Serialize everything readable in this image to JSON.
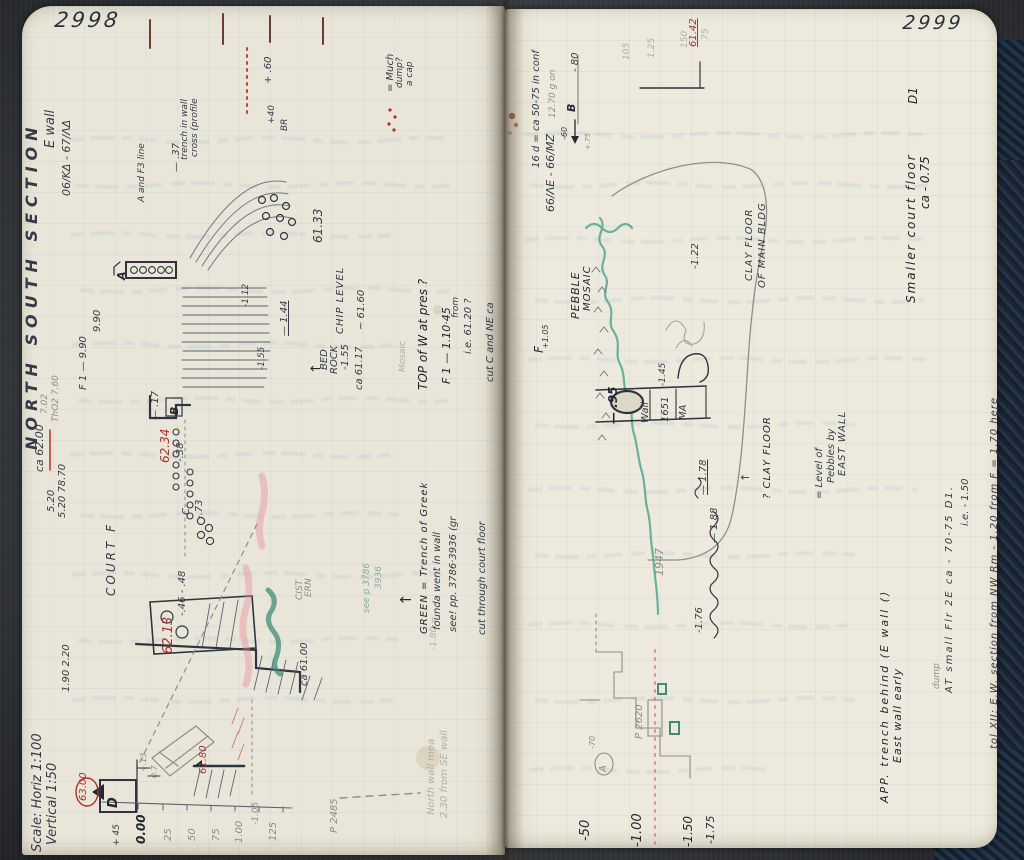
{
  "notebook": {
    "left_page": {
      "page_number": "2998"
    },
    "right_page": {
      "page_number": "2999"
    },
    "colors": {
      "ink": "#343b46",
      "red_ink": "#a63232",
      "green_ink": "#3e8d78",
      "pencil": "#8e8c84",
      "page": "#e9e6d9",
      "cover": "#22344a"
    },
    "annotations": [
      {
        "t": "NORTH  SOUTH  SECTION",
        "x": 24,
        "y": 450,
        "s": 16,
        "ls": 6,
        "c": "ink",
        "w": 600
      },
      {
        "t": "E wall",
        "x": 44,
        "y": 148,
        "s": 13,
        "c": "ink"
      },
      {
        "t": "06/ΚΔ - 67/ΛΔ",
        "x": 61,
        "y": 196,
        "s": 11,
        "c": "ink"
      },
      {
        "t": "ca 62.00",
        "x": 34,
        "y": 472,
        "s": 11,
        "c": "ink"
      },
      {
        "t": "5.20",
        "x": 47,
        "y": 512,
        "s": 10,
        "c": "ink"
      },
      {
        "t": "5.20 78.70",
        "x": 58,
        "y": 518,
        "s": 10,
        "c": "ink"
      },
      {
        "t": "1.90  2.20",
        "x": 62,
        "y": 692,
        "s": 10,
        "c": "ink"
      },
      {
        "t": "Scale:  Horiz  1:100",
        "x": 31,
        "y": 852,
        "s": 13,
        "c": "ink"
      },
      {
        "t": "Vertical 1:50",
        "x": 46,
        "y": 845,
        "s": 13,
        "c": "ink"
      },
      {
        "t": "COURT  F",
        "x": 105,
        "y": 596,
        "s": 12,
        "ls": 3,
        "c": "ink"
      },
      {
        "t": "9.90",
        "x": 93,
        "y": 332,
        "s": 10,
        "c": "ink"
      },
      {
        "t": "F 1  —  9.90",
        "x": 79,
        "y": 390,
        "s": 10,
        "c": "ink"
      },
      {
        "t": "7.02",
        "x": 41,
        "y": 414,
        "s": 9,
        "c": "pencil"
      },
      {
        "t": "ThO2 7.60",
        "x": 52,
        "y": 422,
        "s": 9,
        "c": "pencil"
      },
      {
        "t": "A and F3 line",
        "x": 138,
        "y": 202,
        "s": 9,
        "c": "ink"
      },
      {
        "t": "— .37",
        "x": 172,
        "y": 172,
        "s": 10,
        "c": "ink"
      },
      {
        "t": "trench in wall",
        "x": 181,
        "y": 160,
        "s": 9,
        "c": "ink"
      },
      {
        "t": "cross (profile",
        "x": 191,
        "y": 157,
        "s": 9,
        "c": "ink"
      },
      {
        "t": "= Much",
        "x": 386,
        "y": 92,
        "s": 10,
        "c": "ink"
      },
      {
        "t": "dump?",
        "x": 396,
        "y": 88,
        "s": 9,
        "c": "ink"
      },
      {
        "t": "a cap",
        "x": 406,
        "y": 86,
        "s": 9,
        "c": "ink"
      },
      {
        "t": "+ .60",
        "x": 264,
        "y": 84,
        "s": 10,
        "c": "ink"
      },
      {
        "t": "+40",
        "x": 268,
        "y": 124,
        "s": 9,
        "c": "ink"
      },
      {
        "t": "BR",
        "x": 281,
        "y": 131,
        "s": 9,
        "c": "ink"
      },
      {
        "t": "61.33",
        "x": 312,
        "y": 243,
        "s": 12,
        "c": "ink"
      },
      {
        "t": "A",
        "x": 116,
        "y": 280,
        "s": 11,
        "c": "dark",
        "w": 600
      },
      {
        "t": "CHIP LEVEL",
        "x": 336,
        "y": 334,
        "s": 10,
        "ls": 1,
        "c": "ink"
      },
      {
        "t": "~ 61.60",
        "x": 357,
        "y": 330,
        "s": 10,
        "c": "ink"
      },
      {
        "t": "BED",
        "x": 320,
        "y": 370,
        "s": 10,
        "c": "ink"
      },
      {
        "t": "ROCK",
        "x": 330,
        "y": 374,
        "s": 10,
        "c": "ink"
      },
      {
        "t": "-1.55",
        "x": 341,
        "y": 370,
        "s": 10,
        "c": "ink"
      },
      {
        "t": "ca 61.17",
        "x": 355,
        "y": 390,
        "s": 10,
        "c": "ink"
      },
      {
        "t": "↑",
        "x": 310,
        "y": 374,
        "s": 13,
        "c": "dark"
      },
      {
        "t": "— 1.44",
        "x": 280,
        "y": 336,
        "s": 10,
        "c": "ink",
        "u": true
      },
      {
        "t": "-1.55",
        "x": 258,
        "y": 370,
        "s": 9,
        "c": "ink"
      },
      {
        "t": "-1.12",
        "x": 242,
        "y": 307,
        "s": 9,
        "c": "ink"
      },
      {
        "t": "— .17",
        "x": 151,
        "y": 420,
        "s": 10,
        "c": "ink"
      },
      {
        "t": "B",
        "x": 169,
        "y": 415,
        "s": 11,
        "c": "dark",
        "w": 600
      },
      {
        "t": "62.34",
        "x": 159,
        "y": 463,
        "s": 12,
        "c": "red"
      },
      {
        "t": "-.38",
        "x": 176,
        "y": 462,
        "s": 10,
        "c": "ink"
      },
      {
        "t": "C",
        "x": 182,
        "y": 515,
        "s": 10,
        "c": "ink"
      },
      {
        "t": "-.73",
        "x": 195,
        "y": 519,
        "s": 10,
        "c": "ink"
      },
      {
        "t": "62.13",
        "x": 162,
        "y": 654,
        "s": 13,
        "c": "red"
      },
      {
        "t": "-.46 - .48",
        "x": 178,
        "y": 616,
        "s": 10,
        "c": "ink"
      },
      {
        "t": "ca 61.00",
        "x": 300,
        "y": 686,
        "s": 10,
        "c": "ink"
      },
      {
        "t": "CIST",
        "x": 296,
        "y": 600,
        "s": 9,
        "c": "pencil"
      },
      {
        "t": "ERN",
        "x": 305,
        "y": 597,
        "s": 9,
        "c": "pencil"
      },
      {
        "t": "63.00",
        "x": 79,
        "y": 801,
        "s": 10,
        "c": "red"
      },
      {
        "t": "D",
        "x": 107,
        "y": 808,
        "s": 13,
        "c": "dark",
        "w": 600
      },
      {
        "t": "+ 45",
        "x": 113,
        "y": 846,
        "s": 9,
        "c": "ink"
      },
      {
        "t": "0.00",
        "x": 135,
        "y": 844,
        "s": 12,
        "c": "dark",
        "w": 700
      },
      {
        "t": "25",
        "x": 164,
        "y": 841,
        "s": 10,
        "c": "pencil"
      },
      {
        "t": "50",
        "x": 188,
        "y": 841,
        "s": 10,
        "c": "pencil"
      },
      {
        "t": "75",
        "x": 212,
        "y": 841,
        "s": 10,
        "c": "pencil"
      },
      {
        "t": "1.00",
        "x": 235,
        "y": 843,
        "s": 10,
        "c": "pencil"
      },
      {
        "t": "125",
        "x": 269,
        "y": 841,
        "s": 10,
        "c": "pencil"
      },
      {
        "t": "-1.05",
        "x": 252,
        "y": 825,
        "s": 9,
        "c": "pencil"
      },
      {
        "t": "61.80",
        "x": 199,
        "y": 774,
        "s": 10,
        "c": "red"
      },
      {
        "t": "+.13",
        "x": 140,
        "y": 772,
        "s": 8,
        "c": "pencil"
      },
      {
        "t": "0.7",
        "x": 151,
        "y": 778,
        "s": 8,
        "c": "pencil"
      },
      {
        "t": "P 2485",
        "x": 330,
        "y": 833,
        "s": 10,
        "c": "pencil"
      },
      {
        "t": "North wall mea",
        "x": 427,
        "y": 815,
        "s": 10,
        "c": "faint"
      },
      {
        "t": "2.30 from SE wall",
        "x": 440,
        "y": 818,
        "s": 10,
        "c": "faint"
      },
      {
        "t": "-1.80 =",
        "x": 430,
        "y": 650,
        "s": 9,
        "c": "faint"
      },
      {
        "t": "Mosaic",
        "x": 399,
        "y": 372,
        "s": 9,
        "c": "faint"
      },
      {
        "t": "TOP of W at pres ?",
        "x": 417,
        "y": 390,
        "s": 12,
        "c": "dark"
      },
      {
        "t": "F 1  — 1.10·45",
        "x": 441,
        "y": 384,
        "s": 11,
        "c": "dark"
      },
      {
        "t": "from",
        "x": 452,
        "y": 318,
        "s": 9,
        "c": "ink"
      },
      {
        "t": "i.e. 61.20 ?",
        "x": 464,
        "y": 354,
        "s": 10,
        "c": "ink"
      },
      {
        "t": "cut C and NE ca",
        "x": 486,
        "y": 382,
        "s": 10,
        "c": "ink"
      },
      {
        "t": "↑",
        "x": 399,
        "y": 606,
        "s": 15,
        "c": "dark"
      },
      {
        "t": "GREEN = Trench of Greek",
        "x": 420,
        "y": 634,
        "s": 10,
        "ls": 1,
        "c": "dark"
      },
      {
        "t": "founda went in wall",
        "x": 433,
        "y": 630,
        "s": 10,
        "c": "ink"
      },
      {
        "t": "see! pp. 3786·3936 (gr",
        "x": 449,
        "y": 632,
        "s": 10,
        "c": "ink"
      },
      {
        "t": "cut through court floor",
        "x": 478,
        "y": 635,
        "s": 10,
        "c": "ink"
      },
      {
        "t": "see p 3786",
        "x": 363,
        "y": 613,
        "s": 9,
        "c": "greenpencil"
      },
      {
        "t": "3936",
        "x": 375,
        "y": 589,
        "s": 9,
        "c": "greenpencil"
      },
      {
        "t": "16 d = ca 50-75 in conf",
        "x": 532,
        "y": 168,
        "s": 10,
        "c": "ink"
      },
      {
        "t": "66/ΛΕ - 66/ΜΖ",
        "x": 545,
        "y": 212,
        "s": 11,
        "c": "ink"
      },
      {
        "t": "12.70 g on",
        "x": 549,
        "y": 118,
        "s": 9,
        "c": "pencil"
      },
      {
        "t": "- 80",
        "x": 571,
        "y": 72,
        "s": 10,
        "c": "ink"
      },
      {
        "t": "B",
        "x": 566,
        "y": 112,
        "s": 11,
        "c": "dark",
        "w": 600
      },
      {
        "t": "-60",
        "x": 561,
        "y": 140,
        "s": 8,
        "c": "ink"
      },
      {
        "t": "+.75",
        "x": 585,
        "y": 150,
        "s": 7,
        "c": "pencil"
      },
      {
        "t": "105",
        "x": 623,
        "y": 60,
        "s": 9,
        "c": "faint"
      },
      {
        "t": "1.25",
        "x": 648,
        "y": 58,
        "s": 9,
        "c": "faint"
      },
      {
        "t": "150",
        "x": 681,
        "y": 48,
        "s": 9,
        "c": "faint"
      },
      {
        "t": "75",
        "x": 702,
        "y": 40,
        "s": 9,
        "c": "faint"
      },
      {
        "t": "61.42",
        "x": 689,
        "y": 47,
        "s": 10,
        "c": "red",
        "u": true
      },
      {
        "t": "F",
        "x": 533,
        "y": 353,
        "s": 12,
        "c": "dark"
      },
      {
        "t": "+1.05",
        "x": 542,
        "y": 349,
        "s": 8,
        "c": "ink"
      },
      {
        "t": "PEBBLE",
        "x": 570,
        "y": 319,
        "s": 11,
        "ls": 1,
        "c": "dark"
      },
      {
        "t": "MOSAIC",
        "x": 583,
        "y": 311,
        "s": 10,
        "ls": 1,
        "c": "dark"
      },
      {
        "t": "-1.22",
        "x": 691,
        "y": 269,
        "s": 10,
        "c": "ink"
      },
      {
        "t": "CLAY FLOOR",
        "x": 745,
        "y": 281,
        "s": 10,
        "ls": 1,
        "c": "ink"
      },
      {
        "t": "OF MAIN BLDG",
        "x": 758,
        "y": 288,
        "s": 10,
        "ls": 1,
        "c": "ink"
      },
      {
        "t": "— .95",
        "x": 607,
        "y": 424,
        "s": 12,
        "c": "dark",
        "w": 600
      },
      {
        "t": "Wall",
        "x": 641,
        "y": 423,
        "s": 10,
        "c": "ink"
      },
      {
        "t": "1651",
        "x": 661,
        "y": 422,
        "s": 10,
        "c": "ink"
      },
      {
        "t": "MA",
        "x": 679,
        "y": 420,
        "s": 10,
        "c": "ink"
      },
      {
        "t": "-1.45",
        "x": 659,
        "y": 386,
        "s": 9,
        "c": "ink"
      },
      {
        "t": "— 1.78",
        "x": 699,
        "y": 495,
        "s": 10,
        "c": "ink",
        "u": true
      },
      {
        "t": "— 1.88",
        "x": 710,
        "y": 543,
        "s": 10,
        "c": "ink"
      },
      {
        "t": "1947",
        "x": 654,
        "y": 576,
        "s": 11,
        "c": "pencil"
      },
      {
        "t": "-1.76",
        "x": 695,
        "y": 633,
        "s": 10,
        "c": "ink"
      },
      {
        "t": "↑",
        "x": 740,
        "y": 482,
        "s": 11,
        "c": "ink"
      },
      {
        "t": "? CLAY FLOOR",
        "x": 763,
        "y": 499,
        "s": 10,
        "ls": 1,
        "c": "dark"
      },
      {
        "t": "= Level of",
        "x": 815,
        "y": 499,
        "s": 10,
        "c": "ink"
      },
      {
        "t": "Pebbles by",
        "x": 827,
        "y": 483,
        "s": 10,
        "c": "ink"
      },
      {
        "t": "EAST WALL",
        "x": 838,
        "y": 476,
        "s": 10,
        "ls": 1,
        "c": "ink"
      },
      {
        "t": "D1",
        "x": 907,
        "y": 104,
        "s": 12,
        "c": "dark"
      },
      {
        "t": "Smaller court floor",
        "x": 905,
        "y": 303,
        "s": 12,
        "ls": 2,
        "c": "dark"
      },
      {
        "t": "ca - 0.75",
        "x": 919,
        "y": 209,
        "s": 12,
        "c": "dark"
      },
      {
        "t": "APP. trench behind (E wall ()",
        "x": 879,
        "y": 803,
        "s": 11,
        "ls": 2,
        "c": "dark"
      },
      {
        "t": "East wall early",
        "x": 892,
        "y": 763,
        "s": 11,
        "ls": 1,
        "c": "dark"
      },
      {
        "t": "dump",
        "x": 933,
        "y": 689,
        "s": 9,
        "c": "pencil"
      },
      {
        "t": "AT small Flr 2E ca - 70-75 D1.",
        "x": 945,
        "y": 693,
        "s": 10,
        "ls": 2,
        "c": "ink"
      },
      {
        "t": "i.e. - 1.50",
        "x": 961,
        "y": 526,
        "s": 10,
        "c": "ink"
      },
      {
        "t": "tol XII: E.W. section from NW Rm - 1.20 from F = 1.70 here",
        "x": 990,
        "y": 749,
        "s": 10,
        "ls": 1,
        "c": "ink"
      },
      {
        "t": "-50",
        "x": 579,
        "y": 841,
        "s": 13,
        "c": "dark"
      },
      {
        "t": "-1.00",
        "x": 631,
        "y": 847,
        "s": 13,
        "c": "dark"
      },
      {
        "t": "-1.50",
        "x": 682,
        "y": 847,
        "s": 12,
        "c": "dark"
      },
      {
        "t": "-1.75",
        "x": 705,
        "y": 844,
        "s": 11,
        "c": "dark"
      },
      {
        "t": "P 2620",
        "x": 635,
        "y": 739,
        "s": 10,
        "c": "pencil"
      },
      {
        "t": "-70",
        "x": 589,
        "y": 749,
        "s": 8,
        "c": "pencil"
      },
      {
        "t": "A",
        "x": 599,
        "y": 772,
        "s": 10,
        "c": "pencil"
      }
    ]
  }
}
